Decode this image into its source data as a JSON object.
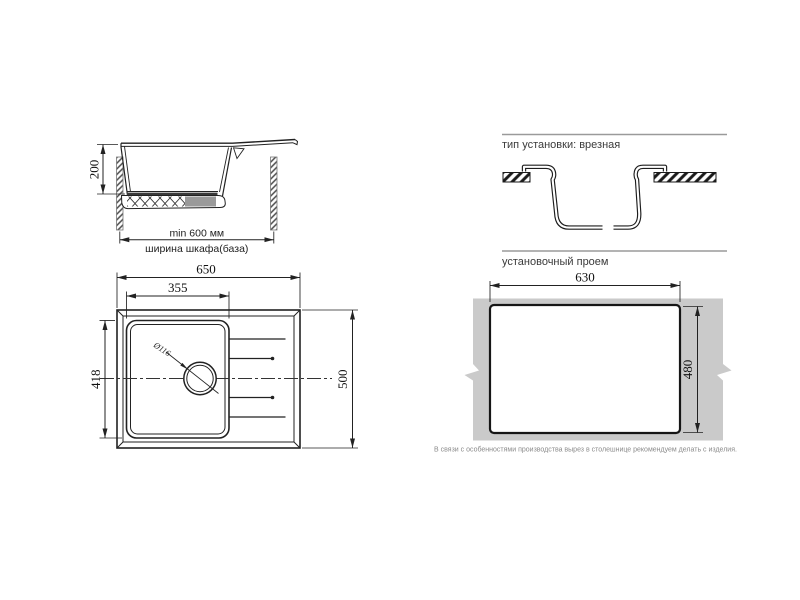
{
  "side_view": {
    "dim_depth": "200",
    "dim_min_width": "min 600 мм",
    "dim_cabinet": "ширина шкафа(база)"
  },
  "top_view": {
    "dim_width": "650",
    "dim_bowl_width": "355",
    "dim_bowl_depth": "418",
    "dim_depth": "500",
    "dim_drain": "Ø116"
  },
  "install_type": {
    "heading": "тип установки: врезная"
  },
  "cutout": {
    "heading": "установочный проем",
    "dim_width": "630",
    "dim_height": "480",
    "note": "В связи с особенностями производства вырез в столешнице рекомендуем делать с изделия."
  },
  "colors": {
    "line": "#1c1c1c",
    "heading_rule": "#9a9a9a",
    "countertop": "#cacaca",
    "note_text": "#8a8a8a"
  }
}
